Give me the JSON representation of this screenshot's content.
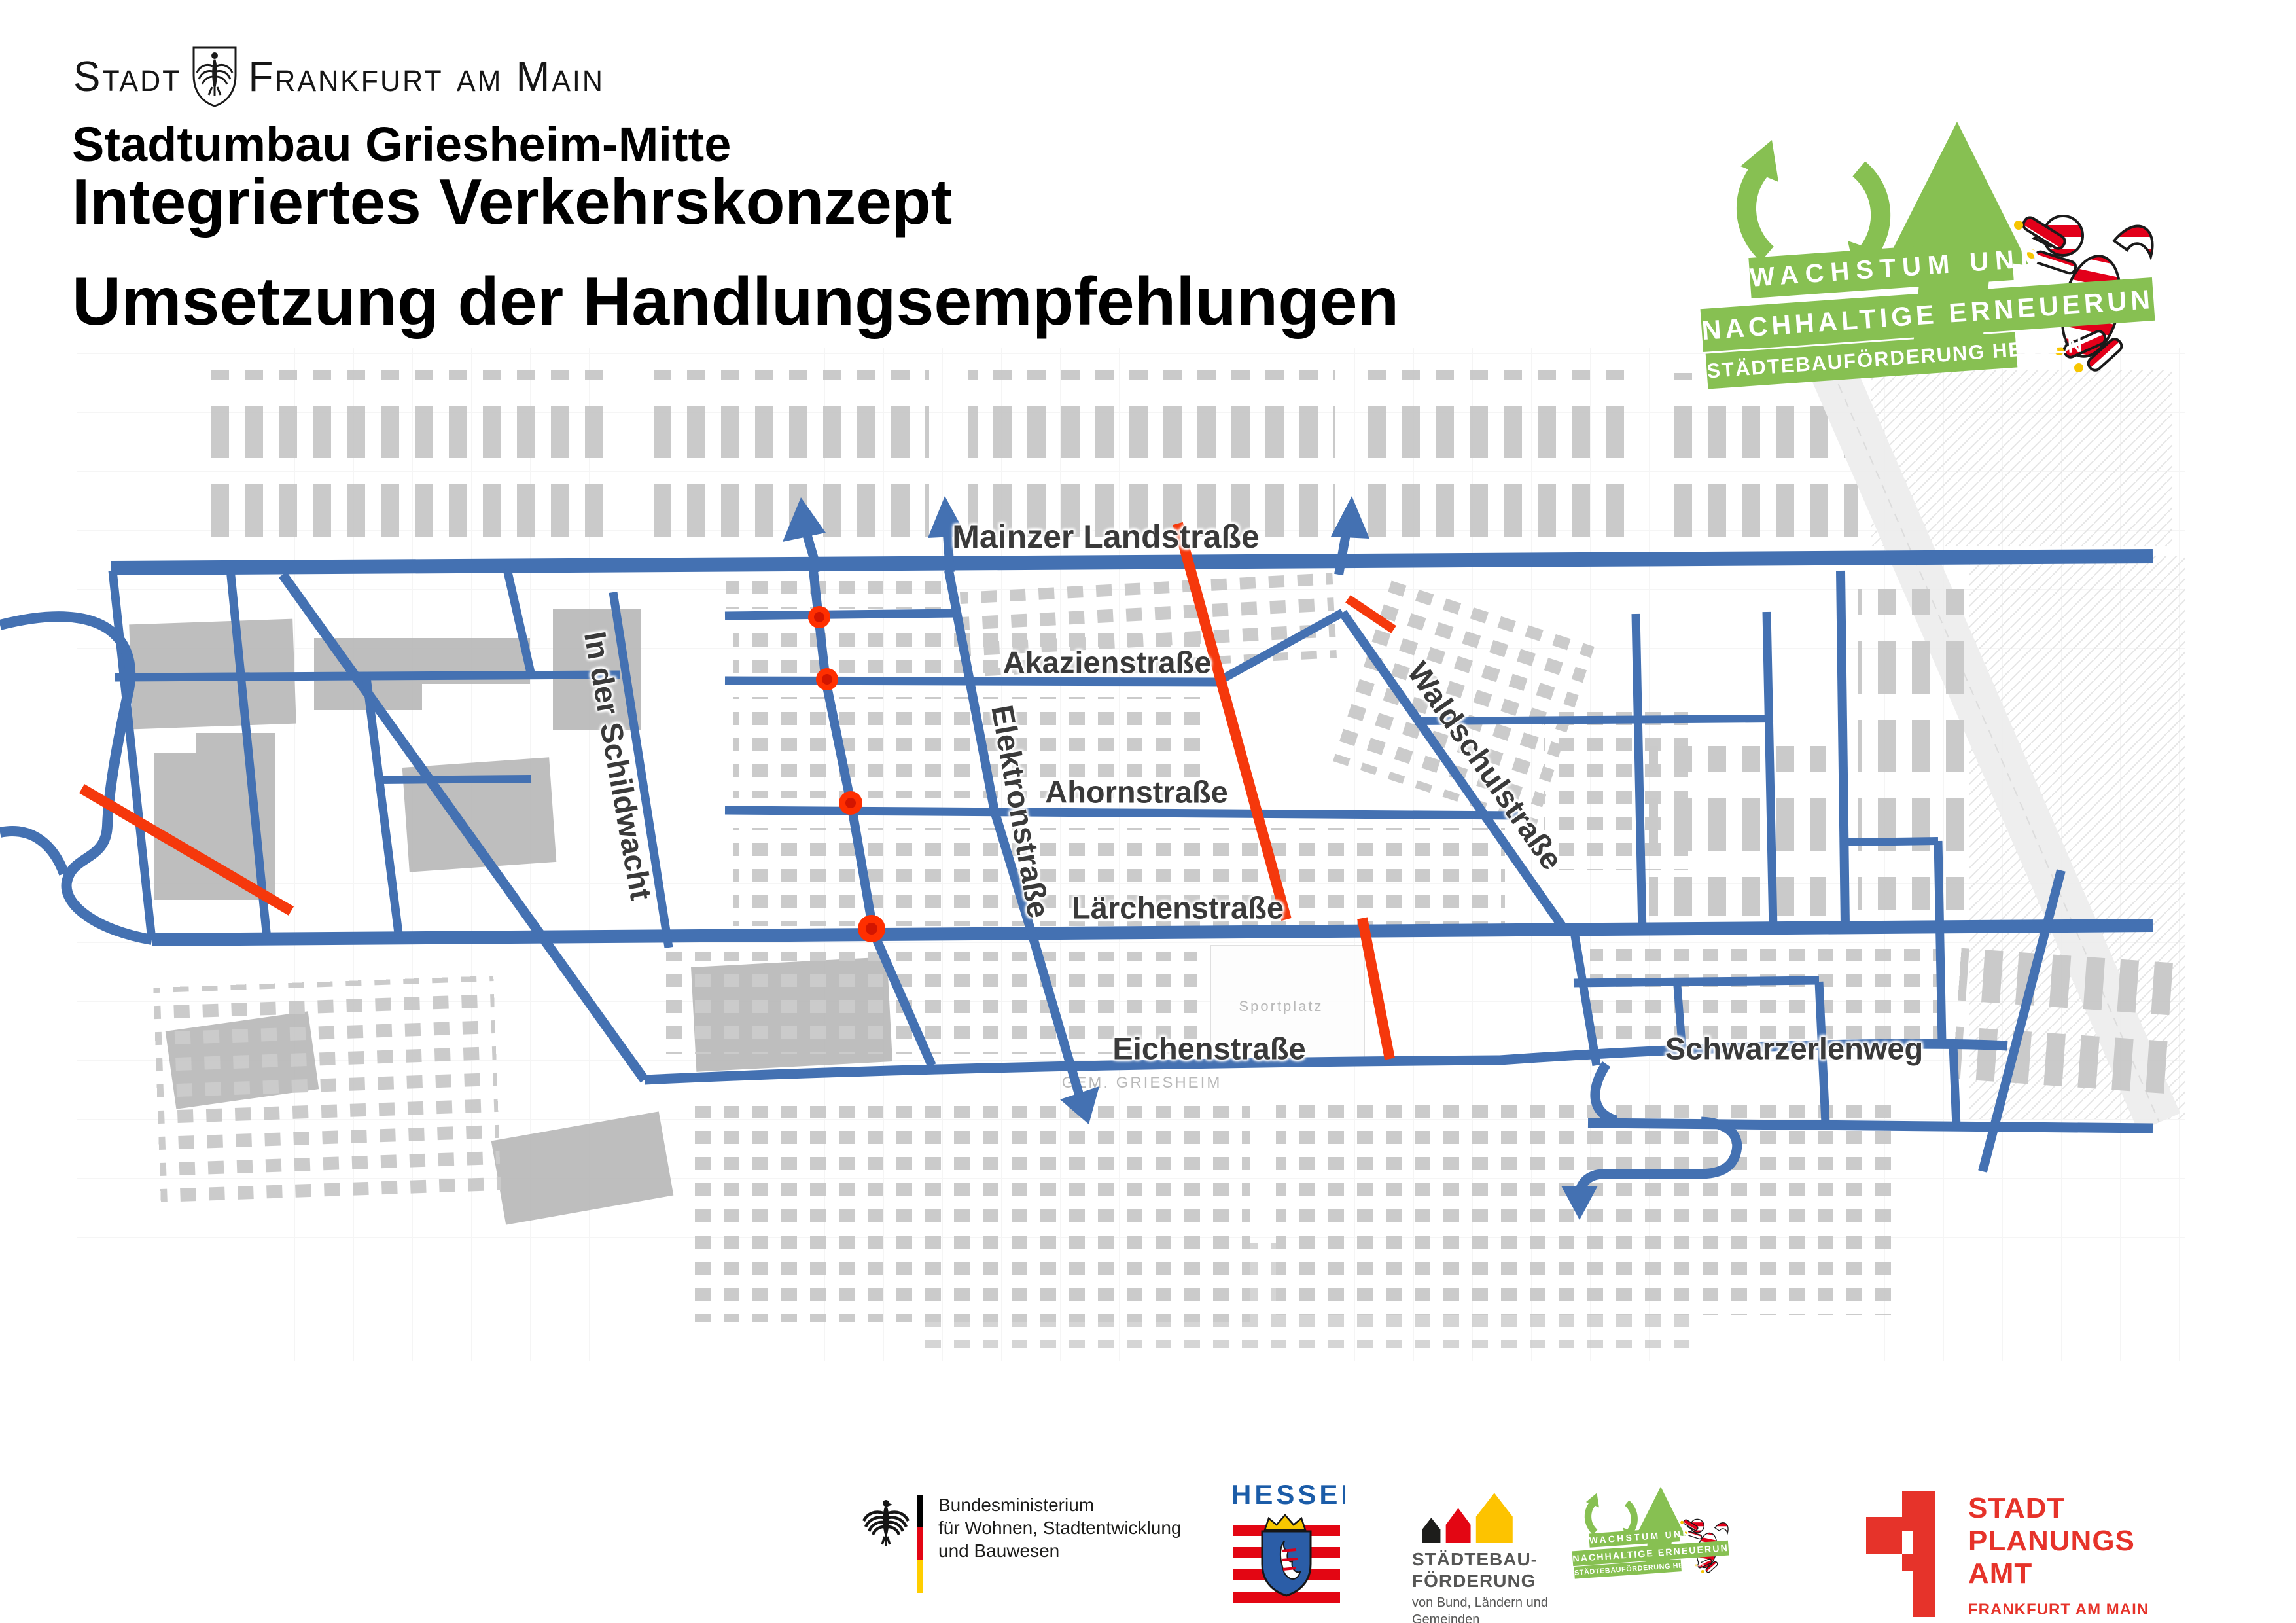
{
  "colors": {
    "road-blue": "#4471B2",
    "measure-red": "#F5380C",
    "logo-green": "#87C052",
    "hessen-blue": "#1B5CA8",
    "stpa-red": "#E6332A",
    "building-gray": "#BDBDBD"
  },
  "header": {
    "city_logo": {
      "word1": "Stadt",
      "word2": "Frankfurt am Main"
    },
    "subtitle": "Stadtumbau Griesheim-Mitte",
    "title": "Integriertes Verkehrskonzept",
    "title2": "Umsetzung der Handlungsempfehlungen"
  },
  "badge": {
    "line1": "WACHSTUM UND",
    "line2": "NACHHALTIGE ERNEUERUNG",
    "line3": "STÄDTEBAUFÖRDERUNG HESSEN"
  },
  "map": {
    "street_labels": [
      "Mainzer Landstraße",
      "Akazienstraße",
      "Ahornstraße",
      "Lärchenstraße",
      "Eichenstraße",
      "Schwarzerlenweg",
      "In der Schildwacht",
      "Elektronstraße",
      "Waldschulstraße"
    ],
    "basemap_labels": [
      "GEM. GRIESHEIM",
      "Sportplatz"
    ]
  },
  "footer": {
    "bmwsb": {
      "line1": "Bundesministerium",
      "line2": "für Wohnen, Stadtentwicklung",
      "line3": "und Bauwesen"
    },
    "hessen": {
      "wordmark": "HESSEN"
    },
    "sbf": {
      "line1": "STÄDTEBAU-",
      "line2": "FÖRDERUNG",
      "line3": "von Bund, Ländern und",
      "line4": "Gemeinden"
    },
    "stpa": {
      "line1": "STADT",
      "line2": "PLANUNGS",
      "line3": "AMT",
      "line4": "FRANKFURT AM MAIN"
    }
  }
}
